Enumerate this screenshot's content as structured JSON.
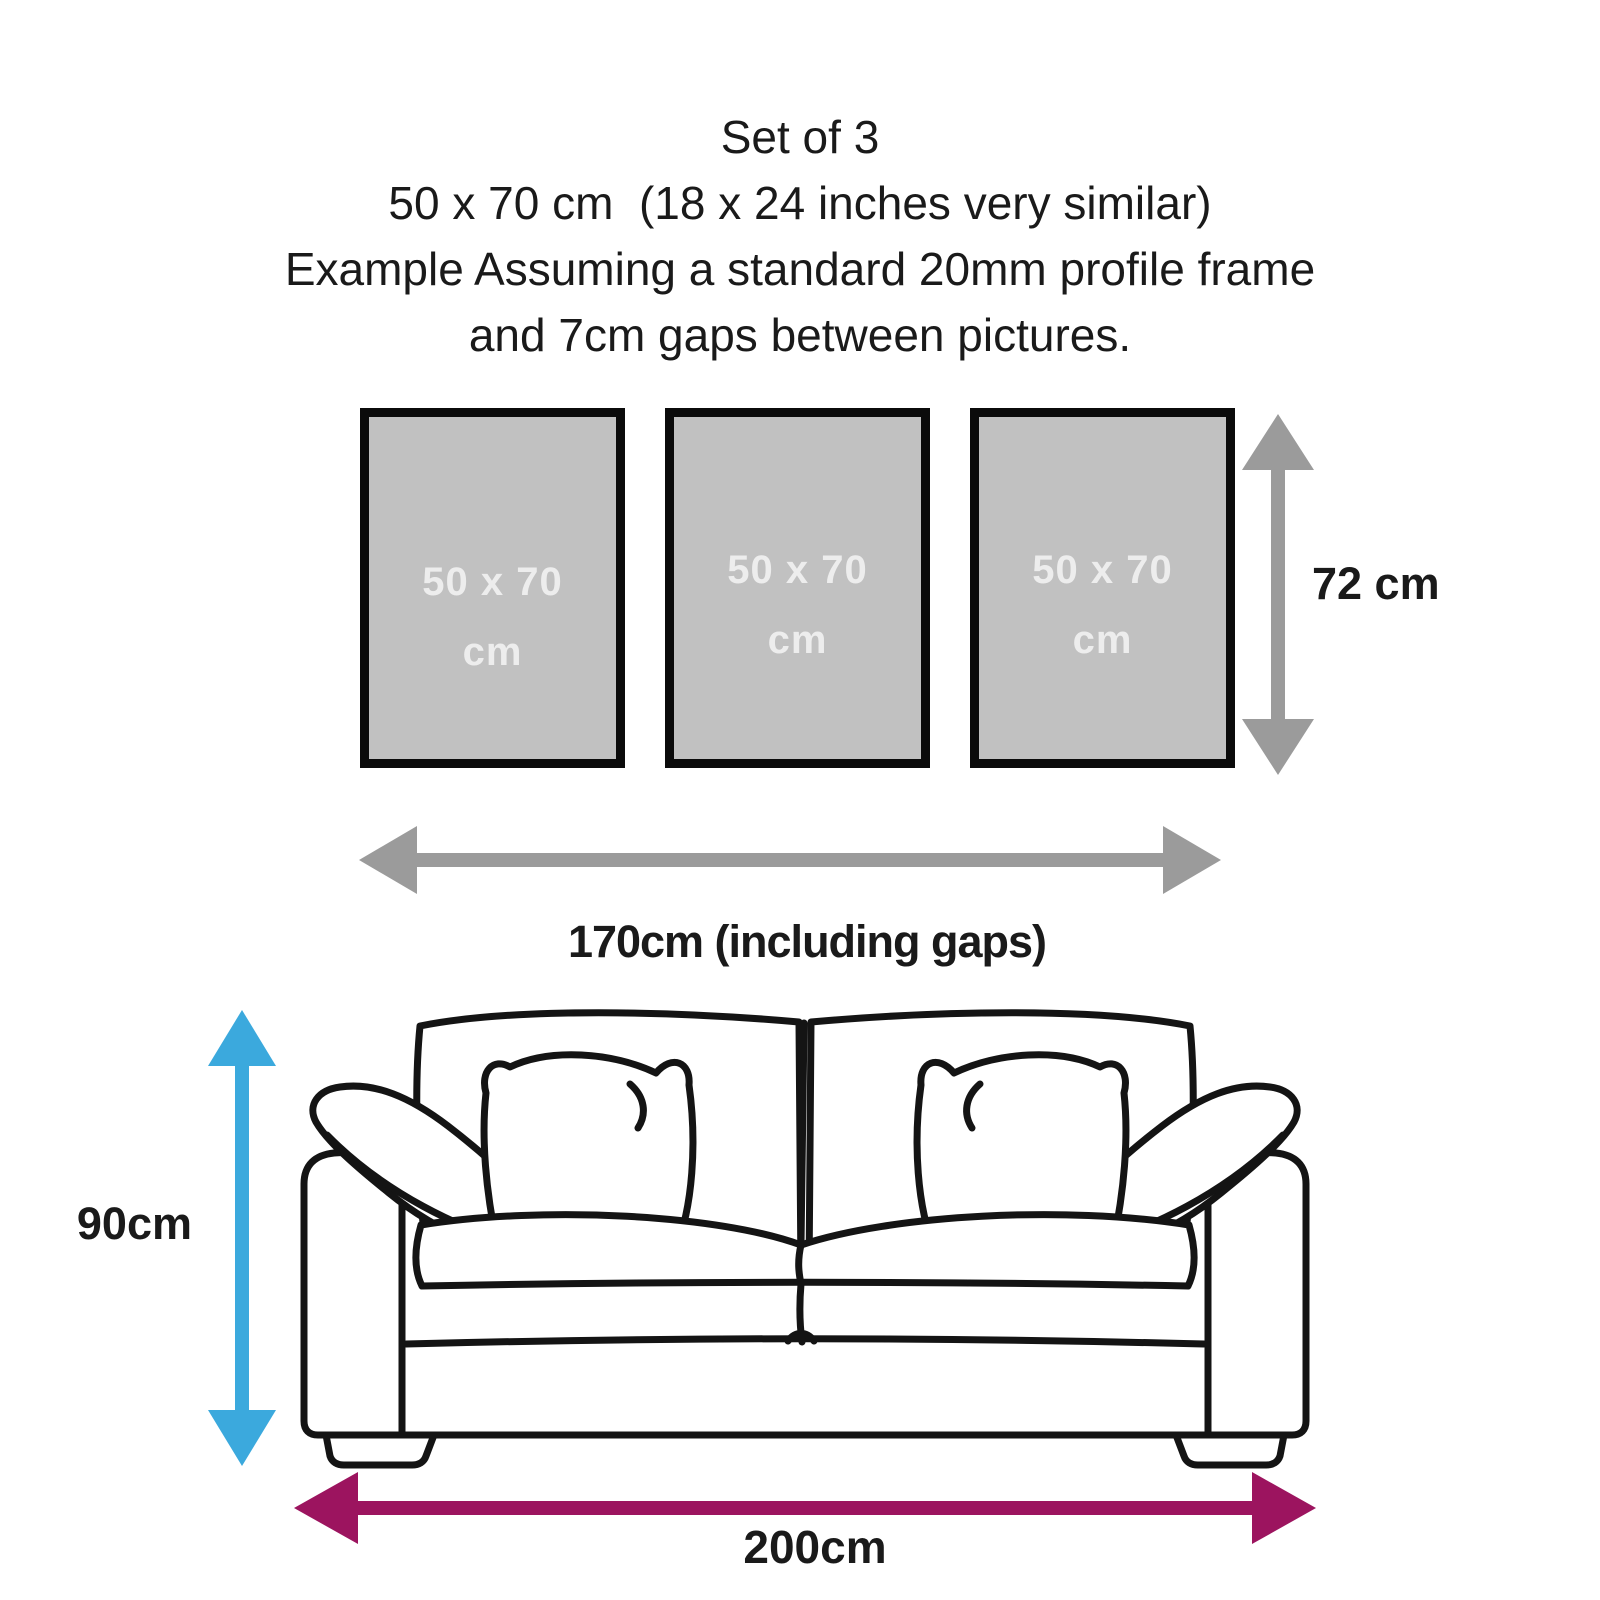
{
  "title_block": {
    "line1": "Set of 3",
    "line2": "50 x 70 cm  (18 x 24 inches very similar)",
    "line3": "Example Assuming a standard 20mm profile frame",
    "line4": "and 7cm gaps between pictures."
  },
  "frames": {
    "items": [
      {
        "size_line1": "50 x 70",
        "size_line2": "cm"
      },
      {
        "size_line1": "50 x 70",
        "size_line2": "cm"
      },
      {
        "size_line1": "50 x 70",
        "size_line2": "cm"
      }
    ]
  },
  "dimensions": {
    "frame_column_height": "72 cm",
    "frames_total_width": "170cm (including gaps)",
    "sofa_height": "90cm",
    "sofa_width": "200cm"
  },
  "colors": {
    "measure_gray": "#9B9B9B",
    "frame_fill": "#C1C1C1",
    "frame_border": "#0B0B0B",
    "frame_label_text": "#EDEDED",
    "sofa_height_blue": "#3BA9DD",
    "sofa_width_purple": "#9C145F",
    "text_black": "#1A1A1A",
    "sofa_outline": "#141414"
  }
}
